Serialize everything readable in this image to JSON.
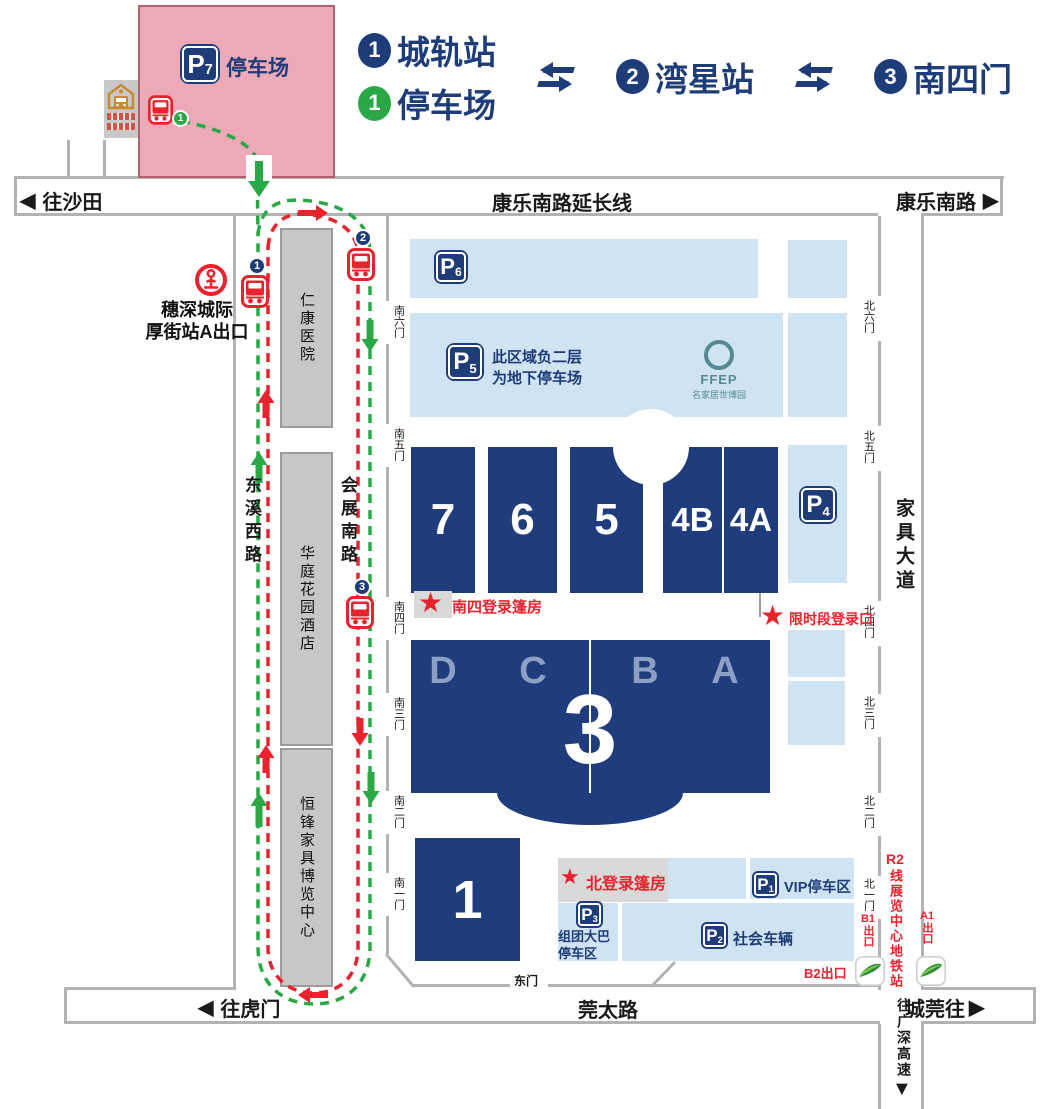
{
  "legend": {
    "stop1_num": "1",
    "stop1_label": "城轨站",
    "parking_num": "1",
    "parking_label": "停车场",
    "stop2_num": "2",
    "stop2_label": "湾星站",
    "stop3_num": "3",
    "stop3_label": "南四门",
    "exchange_arrow": "⇆"
  },
  "roads": {
    "to_shatian": "往沙田",
    "kangle_south_ext": "康乐南路延长线",
    "kangle_south": "康乐南路",
    "to_humen": "往虎门",
    "guantai_road": "莞太路",
    "to_guancheng": "城莞往",
    "jiaju_avenue": "家具大道",
    "to_guangshen_expressway": "往广深高速",
    "dongxi_west_road": "东溪西路",
    "huizhan_south_road": "会展南路",
    "east_gate": "东门",
    "arrow_left": "◀",
    "arrow_right": "▶",
    "arrow_down": "▼"
  },
  "rail_station": {
    "line1": "穗深城际",
    "line2": "厚街站A出口"
  },
  "metro": {
    "r2_prefix": "R2",
    "r2_label": "线展览中心地铁站",
    "b1_prefix": "B1",
    "b1_suffix": "出口",
    "a1_prefix": "A1",
    "a1_suffix": "出口",
    "b2_exit": "B2出口"
  },
  "buildings": {
    "hospital": "仁康医院",
    "hotel": "华庭花园酒店",
    "hengfeng": "恒锋家具博览中心"
  },
  "halls": {
    "h7": "7",
    "h6": "6",
    "h5": "5",
    "h4b": "4B",
    "h4a": "4A",
    "h3": "3",
    "h3_sections": [
      "D",
      "C",
      "B",
      "A"
    ],
    "h1": "1"
  },
  "parking": {
    "p_letter": "P",
    "p7": {
      "num": "7",
      "label": "停车场"
    },
    "p6": {
      "num": "6"
    },
    "p5": {
      "num": "5",
      "note_line1": "此区域负二层",
      "note_line2": "为地下停车场"
    },
    "p4": {
      "num": "4"
    },
    "p1": {
      "num": "1",
      "label": "VIP停车区"
    },
    "p2": {
      "num": "2",
      "label": "社会车辆"
    },
    "p3": {
      "num": "3",
      "label_line1": "组团大巴",
      "label_line2": "停车区"
    }
  },
  "gates": {
    "south": [
      "南六门",
      "南五门",
      "南四门",
      "南三门",
      "南二门",
      "南一门"
    ],
    "north": [
      "北六门",
      "北五门",
      "北四门",
      "北三门",
      "北二门",
      "北一门"
    ]
  },
  "markers": {
    "star": "★",
    "south4_tent": "南四登录篷房",
    "limited_entry": "限时段登录口",
    "north_tent": "北登录篷房"
  },
  "ffep": {
    "name": "FFEP",
    "subtitle": "名家居世博园"
  },
  "bus_stops": {
    "stop1": "1",
    "stop2": "2",
    "stop3": "3",
    "p7_stop": "1"
  },
  "colors": {
    "navy": "#1e3c78",
    "hall_blue": "#1f3c7d",
    "light_blue": "#cfe3f2",
    "pink": "#ecaab8",
    "red": "#e8232d",
    "green": "#2aa845",
    "teal": "#558a94",
    "gray_building": "#c7c7c7",
    "road_border": "#b3b3b3",
    "hall3_letters": "#8ba0c4"
  }
}
